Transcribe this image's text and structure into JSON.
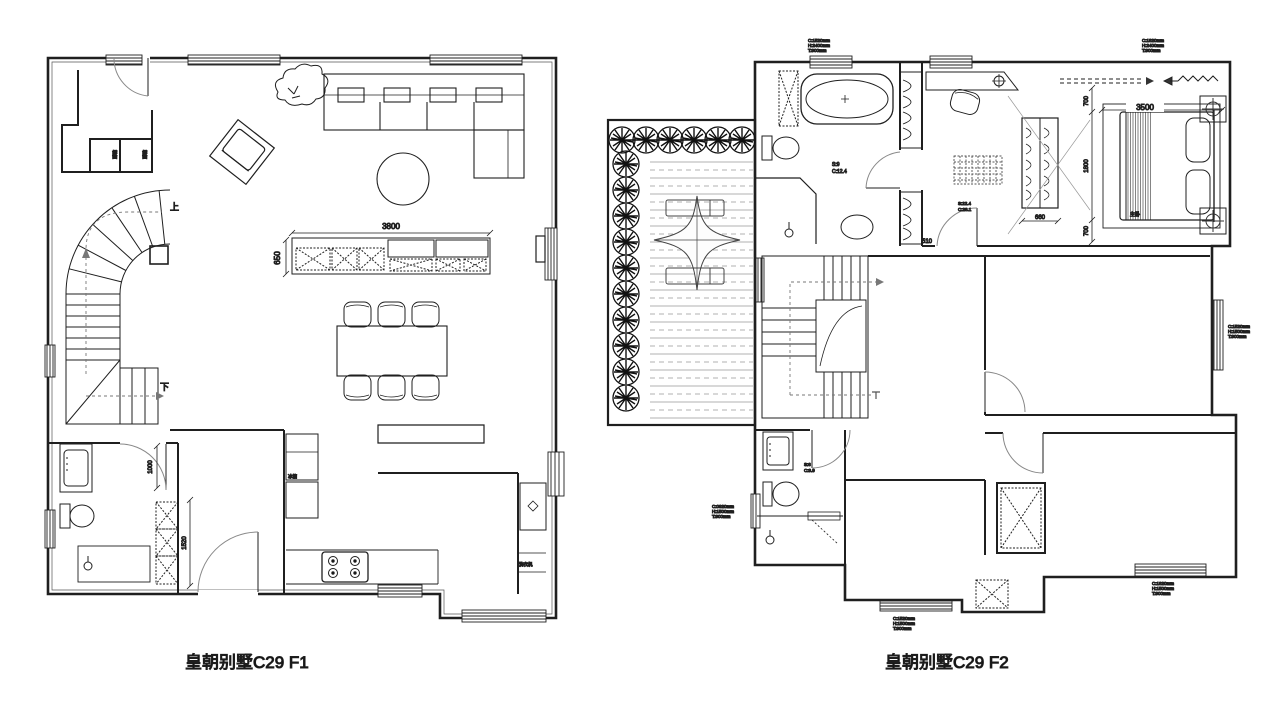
{
  "page": {
    "background": "#ffffff",
    "ink": "#1f1f1f"
  },
  "captions": {
    "f1": "皇朝别墅C29 F1",
    "f2": "皇朝别墅C29 F2"
  },
  "f1": {
    "dims": {
      "tv_width": "3800",
      "tv_depth": "650",
      "bath_door": "1000",
      "bath_cabinet": "1520"
    },
    "stair": {
      "up": "上",
      "down": "下"
    },
    "labels": {
      "closet_a": "鞋柜",
      "closet_b": "鞋柜",
      "fridge": "冰箱",
      "washer": "洗衣机"
    }
  },
  "f2": {
    "dims": {
      "room_width": "3500",
      "bed_length": "1800",
      "gap_top": "700",
      "gap_bottom": "700",
      "wardrobe": "660",
      "door": "510"
    },
    "rooms": {
      "master": "主卧"
    },
    "areas": {
      "bath_top": [
        "S:9",
        "C:12.4"
      ],
      "master": [
        "S:22.4",
        "C:28.1"
      ],
      "bath_bottom": [
        "S:6",
        "C:9.9"
      ]
    },
    "annotations": {
      "a1": [
        "C:1520mm",
        "H:2400mm",
        "T:900mm"
      ],
      "a2": [
        "C:1820mm",
        "H:2400mm",
        "T:900mm"
      ],
      "a3": [
        "C:1520mm",
        "H:1500mm",
        "T:900mm"
      ],
      "a4": [
        "C:0920mm",
        "H:1500mm",
        "T:900mm"
      ],
      "a5": [
        "C:1820mm",
        "H:1500mm",
        "T:900mm"
      ],
      "a6": [
        "C:1520mm",
        "H:1500mm",
        "T:900mm"
      ]
    }
  }
}
